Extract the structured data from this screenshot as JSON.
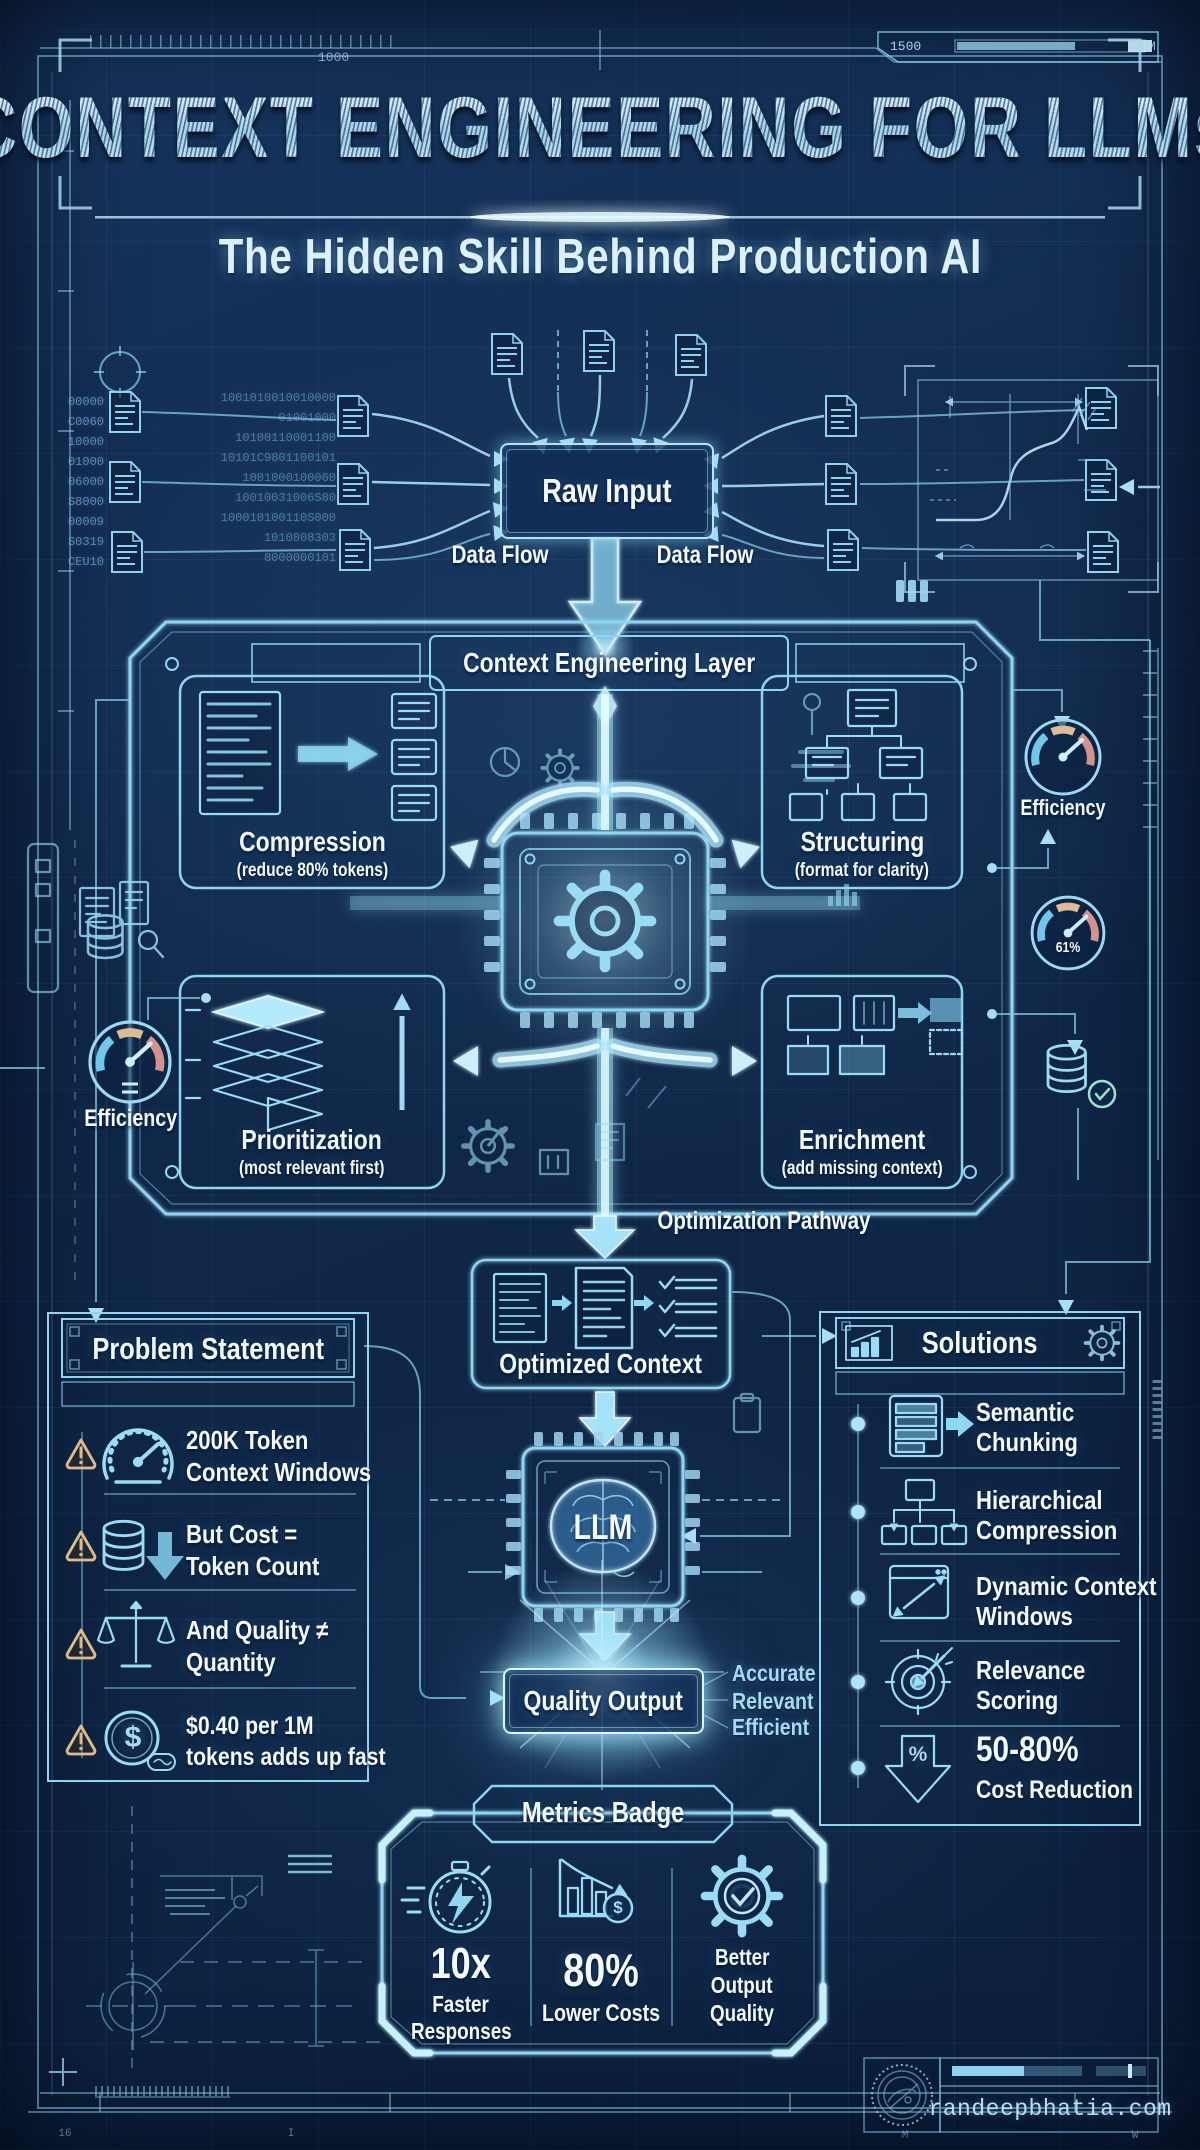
{
  "header": {
    "title": "CONTEXT ENGINEERING FOR LLMs",
    "subtitle": "The Hidden Skill Behind Production AI"
  },
  "rulers": {
    "top_left": "1000",
    "top_right": "1500",
    "top_unit": "M",
    "mark1": "16",
    "mark2": "I",
    "mark3": "M",
    "mark4": "W"
  },
  "flow": {
    "raw_input": "Raw Input",
    "data_flow_left": "Data Flow",
    "data_flow_right": "Data Flow",
    "optimization_pathway": "Optimization Pathway",
    "optimized_context": "Optimized Context",
    "llm": "LLM",
    "quality_output": "Quality Output",
    "tag1": "Accurate",
    "tag2": "Relevant",
    "tag3": "Efficient"
  },
  "layer": {
    "title": "Context Engineering Layer",
    "compression": {
      "name": "Compression",
      "desc": "(reduce 80% tokens)"
    },
    "structuring": {
      "name": "Structuring",
      "desc": "(format for clarity)"
    },
    "prioritization": {
      "name": "Prioritization",
      "desc": "(most relevant first)"
    },
    "enrichment": {
      "name": "Enrichment",
      "desc": "(add missing context)"
    }
  },
  "problem": {
    "title": "Problem Statement",
    "items": [
      {
        "line1": "200K Token",
        "line2": "Context Windows",
        "icon": "gauge-icon"
      },
      {
        "line1": "But Cost =",
        "line2": "Token Count",
        "icon": "database-down-icon"
      },
      {
        "line1": "And Quality ≠",
        "line2": "Quantity",
        "icon": "scales-icon"
      },
      {
        "line1": "$0.40 per 1M",
        "line2": "tokens adds up fast",
        "icon": "dollar-coin-icon"
      }
    ]
  },
  "solutions": {
    "title": "Solutions",
    "items": [
      {
        "line1": "Semantic",
        "line2": "Chunking",
        "icon": "chunking-icon"
      },
      {
        "line1": "Hierarchical",
        "line2": "Compression",
        "icon": "tree-icon"
      },
      {
        "line1": "Dynamic Context",
        "line2": "Windows",
        "icon": "window-expand-icon"
      },
      {
        "line1": "Relevance",
        "line2": "Scoring",
        "icon": "target-icon"
      },
      {
        "line1": "50-80%",
        "line2": "Cost Reduction",
        "icon": "percent-down-icon"
      }
    ]
  },
  "metrics": {
    "title": "Metrics Badge",
    "m1": {
      "value": "10x",
      "line1": "Faster",
      "line2": "Responses"
    },
    "m2": {
      "value": "80%",
      "line1": "Lower Costs"
    },
    "m3": {
      "line1": "Better",
      "line2": "Output",
      "line3": "Quality"
    }
  },
  "gauges": {
    "left_label": "Efficiency",
    "right_label": "Efficiency",
    "right_value": "61%"
  },
  "footer": {
    "site": "randeepbhatia.com"
  },
  "decor": {
    "dollar": "$",
    "percent": "%",
    "binary_left": "00000\nC0060\n10000\n01000\n06000\nS8000\n00009\nS0319\nCEU10",
    "binary_mid": "1001010010010000\n01001000\n10100110001100\n10101C9801100101\n1001000100060\n10010031006S80\n100010100110S000\n1010808303\n8000000101"
  }
}
